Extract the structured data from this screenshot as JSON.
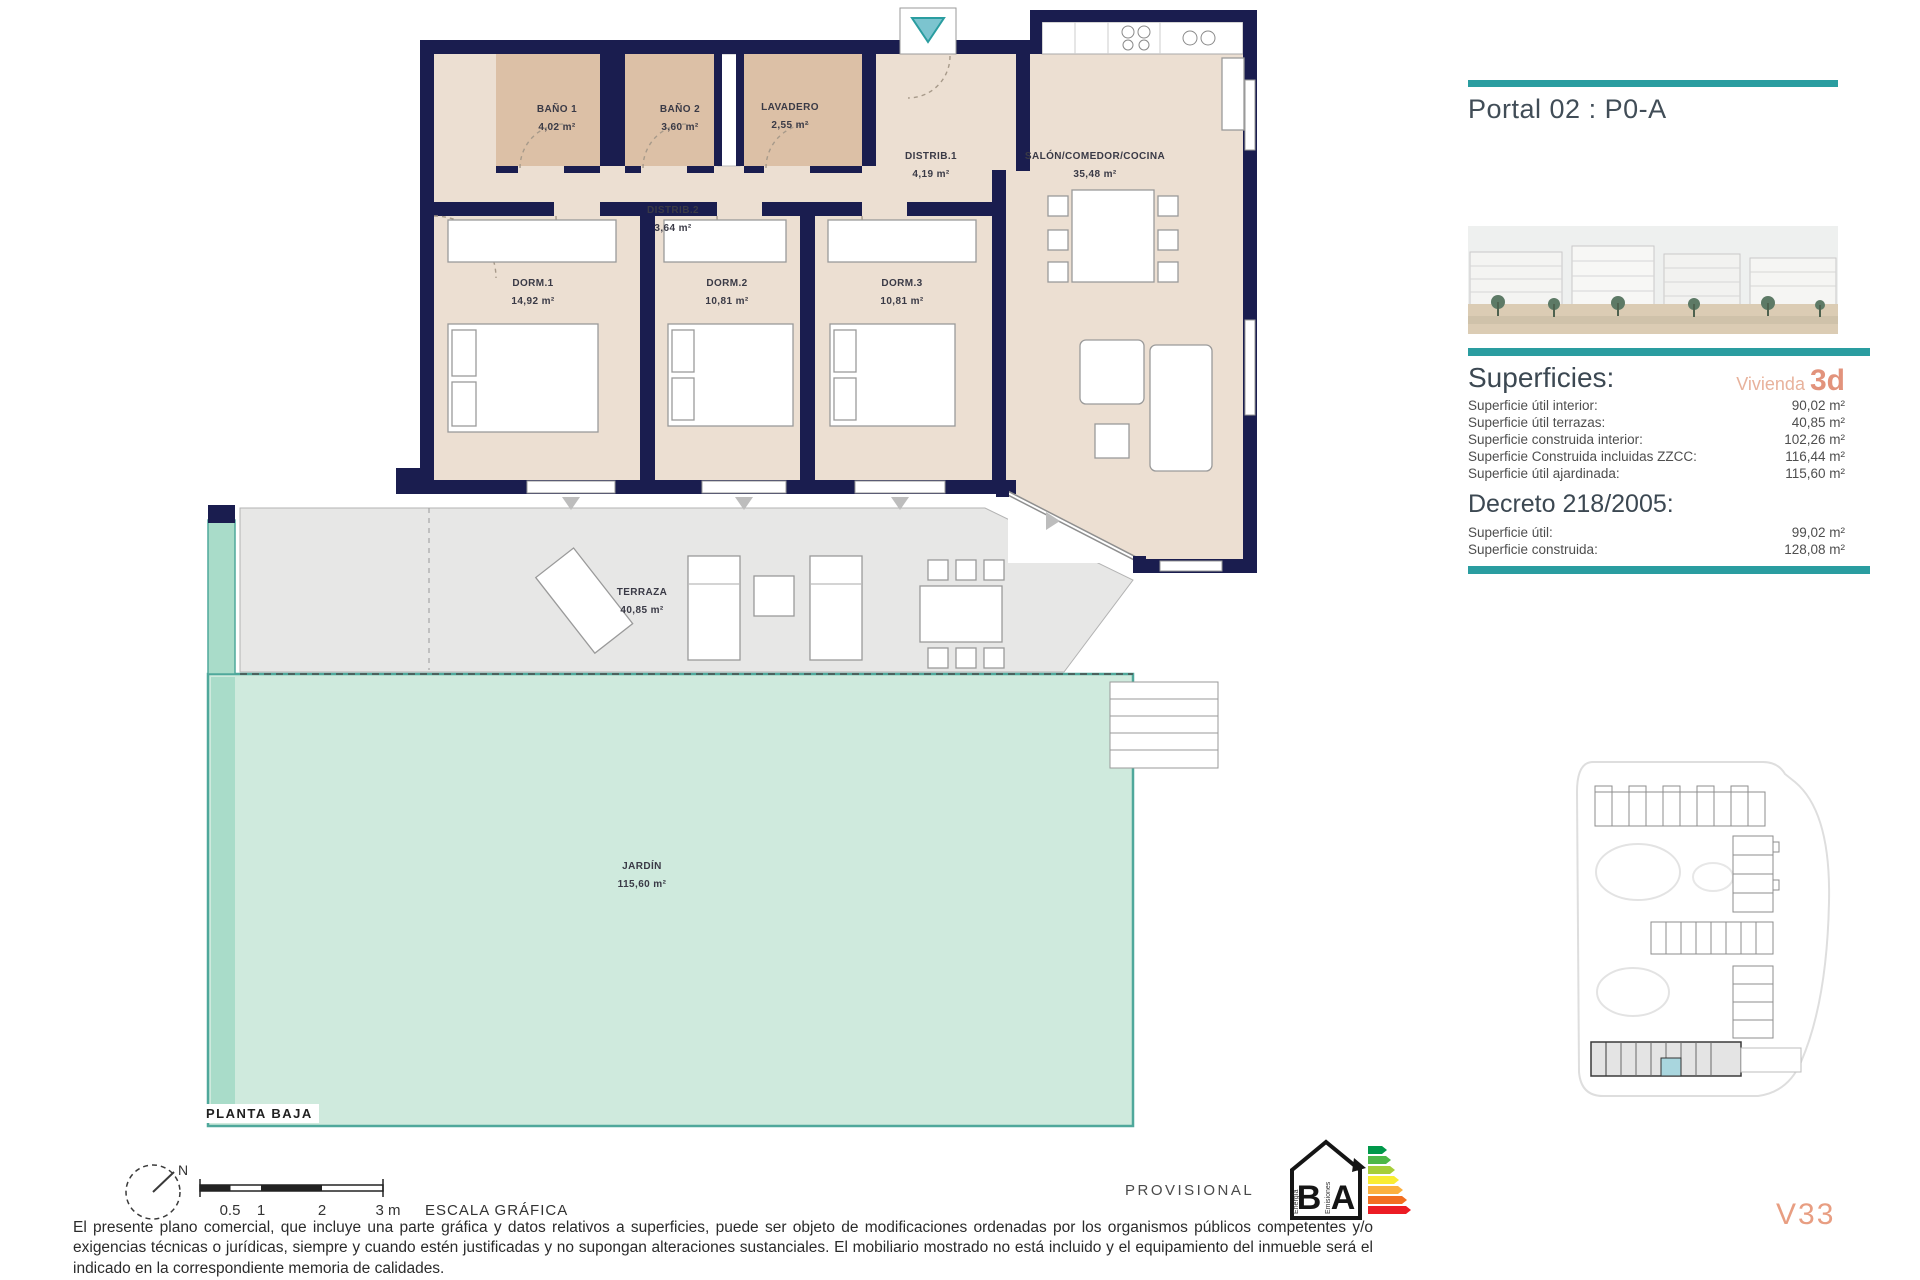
{
  "colors": {
    "accent_teal": "#2a9da0",
    "accent_salmon": "#e2937c",
    "wall_navy": "#1a1d4f",
    "room_beige": "#ecdfd2",
    "bath_tan": "#dcc0a6",
    "garden_mint": "#cfeadd",
    "terrace_gray": "#e7e7e6"
  },
  "plan": {
    "floor_label": "PLANTA BAJA",
    "rooms": [
      {
        "id": "bano1",
        "name": "BAÑO 1",
        "area": "4,02 m²"
      },
      {
        "id": "bano2",
        "name": "BAÑO 2",
        "area": "3,60 m²"
      },
      {
        "id": "lavadero",
        "name": "LAVADERO",
        "area": "2,55 m²"
      },
      {
        "id": "distrib1",
        "name": "DISTRIB.1",
        "area": "4,19 m²"
      },
      {
        "id": "distrib2",
        "name": "DISTRIB.2",
        "area": "3,64 m²"
      },
      {
        "id": "salon",
        "name": "SALÓN/COMEDOR/COCINA",
        "area": "35,48 m²"
      },
      {
        "id": "dorm1",
        "name": "DORM.1",
        "area": "14,92 m²"
      },
      {
        "id": "dorm2",
        "name": "DORM.2",
        "area": "10,81 m²"
      },
      {
        "id": "dorm3",
        "name": "DORM.3",
        "area": "10,81 m²"
      },
      {
        "id": "terraza",
        "name": "TERRAZA",
        "area": "40,85 m²"
      },
      {
        "id": "jardin",
        "name": "JARDÍN",
        "area": "115,60 m²"
      }
    ]
  },
  "panel": {
    "title": "Portal 02 : P0-A",
    "superficies": {
      "heading": "Superficies:",
      "vivienda_label": "Vivienda",
      "vivienda_code": "3d",
      "rows": [
        {
          "label": "Superficie útil interior:",
          "value": "90,02 m²"
        },
        {
          "label": "Superficie útil terrazas:",
          "value": "40,85 m²"
        },
        {
          "label": "Superficie construida interior:",
          "value": "102,26 m²"
        },
        {
          "label": "Superficie Construida incluidas ZZCC:",
          "value": "116,44 m²"
        },
        {
          "label": "Superficie útil ajardinada:",
          "value": "115,60 m²"
        }
      ]
    },
    "decreto": {
      "heading": "Decreto 218/2005:",
      "rows": [
        {
          "label": "Superficie útil:",
          "value": "99,02 m²"
        },
        {
          "label": "Superficie construida:",
          "value": "128,08 m²"
        }
      ]
    }
  },
  "footer": {
    "north_label": "N",
    "scale": {
      "ticks": [
        "0.5",
        "1",
        "2",
        "3 m"
      ],
      "label": "ESCALA GRÁFICA"
    },
    "provisional": "PROVISIONAL",
    "energy": {
      "letter_b": "B",
      "letter_a": "A",
      "word_energy": "Energía",
      "word_emissions": "Emisiones"
    },
    "disclaimer": "El presente plano comercial, que incluye una parte gráfica y datos relativos a superficies, puede ser objeto de modificaciones ordenadas por los organismos públicos competentes y/o exigencias técnicas o jurídicas, siempre y cuando estén justificadas y no supongan alteraciones sustanciales. El mobiliario mostrado no está incluido y el equipamiento del inmueble será el indicado en la correspondiente memoria de calidades.",
    "version": "V33"
  }
}
